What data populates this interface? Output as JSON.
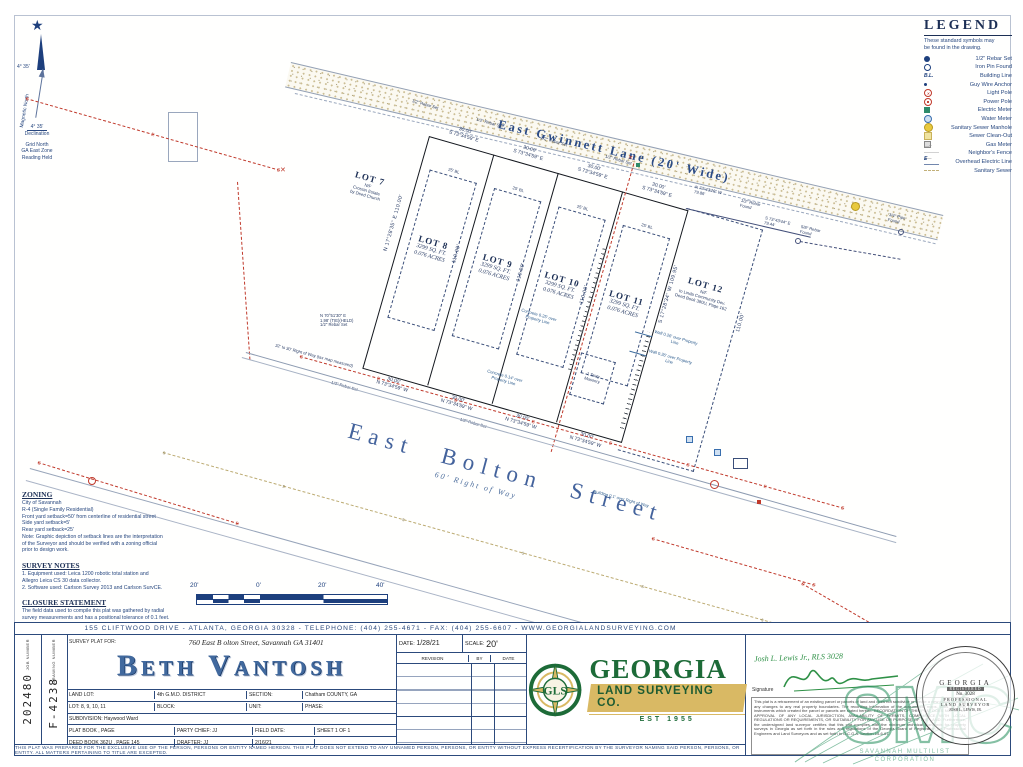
{
  "north_arrow": {
    "star": "★",
    "angle": "4° 35'",
    "magnetic": "Magnetic North",
    "declination_value": "4° 35'",
    "declination_word": "Declination",
    "grid_lines": [
      "Grid North",
      "GA East Zone",
      "Reading Held"
    ]
  },
  "legend": {
    "title": "LEGEND",
    "subtitle_lines": [
      "These standard symbols may",
      "be found in the drawing."
    ],
    "items": [
      {
        "icon": "rebar-set-icon",
        "label": "1/2\" Rebar Set"
      },
      {
        "icon": "iron-pin-found-icon",
        "label": "Iron Pin Found"
      },
      {
        "icon": "building-line-icon",
        "label": "Building Line",
        "glyph": "B.L."
      },
      {
        "icon": "guy-wire-anchor-icon",
        "label": "Guy Wire Anchor"
      },
      {
        "icon": "light-pole-icon",
        "label": "Light Pole",
        "glyph": "✕"
      },
      {
        "icon": "power-pole-icon",
        "label": "Power Pole"
      },
      {
        "icon": "electric-meter-icon",
        "label": "Electric Meter"
      },
      {
        "icon": "water-meter-icon",
        "label": "Water Meter"
      },
      {
        "icon": "sanitary-sewer-manhole-icon",
        "label": "Sanitary Sewer Manhole"
      },
      {
        "icon": "sewer-clean-out-icon",
        "label": "Sewer Clean-Out"
      },
      {
        "icon": "gas-meter-icon",
        "label": "Gas Meter"
      },
      {
        "icon": "neighbors-fence-icon",
        "label": "Neighbor's Fence",
        "glyph": "—x———x—"
      },
      {
        "icon": "overhead-electric-line-icon",
        "label": "Overhead Electric Line",
        "glyph": "E ———"
      },
      {
        "icon": "sanitary-sewer-icon",
        "label": "Sanitary Sewer"
      }
    ]
  },
  "drawing": {
    "gwinnett_label": "East Gwinnett Lane (20' Wide)",
    "bolton_label": "East Bolton Street",
    "bolton_row": "60' Right of Way",
    "symbols": {
      "e": "E",
      "s": "s",
      "x": "✕"
    },
    "lots": [
      {
        "name": "LOT 7",
        "note_lines": [
          "N/F",
          "Crossin Estate",
          "by Deed Church"
        ]
      },
      {
        "name": "LOT 8",
        "sqft": "3299 SQ. FT.",
        "acres": "0.076 ACRES"
      },
      {
        "name": "LOT 9",
        "sqft": "3299 SQ. FT.",
        "acres": "0.076 ACRES"
      },
      {
        "name": "LOT 10",
        "sqft": "3299 SQ. FT.",
        "acres": "0.076 ACRES"
      },
      {
        "name": "LOT 11",
        "sqft": "3299 SQ. FT.",
        "acres": "0.076 ACRES"
      },
      {
        "name": "LOT 12",
        "note_lines": [
          "N/F",
          "to Linda Community Dev.",
          "Deed Book 380U, Page 162"
        ]
      }
    ],
    "dims": {
      "front_dist": "30.00'",
      "front_bearing": "S 73°34'59\" E",
      "rear_bearing": "N 73°34'59\" W",
      "side_w_full": "N 17°28'35\" E  110.00'",
      "side_dist": "110.00'",
      "side_e_full": "S 17°28'34\" W  109.95'",
      "tie_w_bearing": "N 73°43'26\" W",
      "tie_w_dist": "79.86'",
      "tie_e_bearing": "S 73°43'44\" E",
      "tie_e_dist": "79.44'"
    },
    "monuments": {
      "rebar_set": "1/2\" Rebar Set",
      "rebar_found": "1/2\" Rebar Found",
      "rebar58_found": "5/8\" Rebar Found",
      "pipe34_found": "3/4\" Pipe Found"
    },
    "callouts": {
      "setback": "25' BL",
      "concrete25": "Concrete 0.25' over Property Line",
      "concrete14": "Concrete 0.14' over Property Line",
      "wall26": "Wall 0.26' over Property Line",
      "building_over": "Building 0.1' over Right of Way",
      "masonry_lines": [
        "1 Story",
        "Masonry"
      ],
      "tie_note_lines": [
        "N 70°51'30\" E",
        "1.98' (TIE)(HELD)",
        "1/2\" Rebar Set"
      ],
      "row_note": "32' to 30' Right of Way (tax map measured)"
    }
  },
  "notes": {
    "zoning_title": "ZONING",
    "zoning_lines": [
      "City of Savannah",
      "R-4 (Single Family Residential)",
      "Front yard setback=50' from centerline of residential street",
      "Side yard setback=5'",
      "Rear yard setback=25'",
      "Note: Graphic depiction of setback lines are the interpretation",
      "of the Surveyor and should be verified with a zoning official",
      "prior to design work."
    ],
    "survey_title": "SURVEY NOTES",
    "survey_lines": [
      "1.  Equipment used: Leica 1200 robotic total station and",
      "     Allegro Leica CS 30 data collector.",
      "2.  Software used: Carlson Survey 2013 and Carlson SurvCE."
    ],
    "closure_title": "CLOSURE STATEMENT",
    "closure_lines": [
      "The field data used to compile this plat was gathered by radial",
      "survey measurements and has a positional tolerance of 0.1 feet.",
      "This map or plat has been calculated for closure and is found to",
      "be accurate within one foot in 252,655 feet."
    ]
  },
  "scalebar": {
    "labels": [
      "20'",
      "0'",
      "20'",
      "40'"
    ]
  },
  "titleblock": {
    "banner": "155 CLIFTWOOD DRIVE - ATLANTA, GEORGIA 30328 - TELEPHONE: (404) 255-4671 - FAX: (404) 255-6607 - WWW.GEORGIALANDSURVEYING.COM",
    "job_number_label": "JOB NUMBER",
    "job_number": "202480",
    "drawing_number_label": "DRAWING NUMBER",
    "drawing_number": "F-4238",
    "survey_plat_for_label": "SURVEY PLAT FOR:",
    "site_address": "760 East B olton Street, Savannah GA 31401",
    "client_name": "Beth Vantosh",
    "fields": {
      "land_lot_label": "LAND LOT:",
      "district": "4th G.M.D. DISTRICT",
      "section_label": "SECTION:",
      "county": "Chatham COUNTY, GA",
      "lot_label": "LOT:  8, 9, 10, 11",
      "block_label": "BLOCK:",
      "unit_label": "UNIT:",
      "phase_label": "PHASE:",
      "subdivision": "SUBDIVISION:  Haywood Ward",
      "plat_book": "PLAT BOOK          , PAGE",
      "party_chief": "PARTY CHIEF:   JJ",
      "field_date_label": "FIELD DATE:",
      "field_date": "2/16/21",
      "sheet": "SHEET   1   OF   1",
      "deed_book": "DEED BOOK  362U    , PAGE  145",
      "drafter": "DRAFTER:        JJ"
    },
    "date_label": "DATE:",
    "date": "1/28/21",
    "scale_label": "SCALE:",
    "scale": "20'",
    "revision_header": [
      "REVISION",
      "BY",
      "DATE"
    ],
    "logo": {
      "monogram": "GLS",
      "name": "GEORGIA",
      "subname": "LAND SURVEYING CO.",
      "est": "EST 1955"
    },
    "surveyor": {
      "name_line": "Josh L. Lewis Jr., RLS 3028",
      "signature_label": "Signature",
      "certification": "This plat is a retracement of an existing parcel or parcels of land and does not subdivide or create a new parcel or make any changes to any real property boundaries. The recording information of the documents, maps, plats, or other instruments which created the parcel or parcels are stated hereon. RECORDATION OF THIS PLAT DOES NOT IMPLY APPROVAL OF ANY LOCAL JURISDICTION, AVAILABILITY OF PERMITS, COMPLIANCE WITH LOCAL REGULATIONS OR REQUIREMENTS, OR SUITABILITY FOR ANY USE OR PURPOSE OF THE LAND. Furthermore, the undersigned land surveyor certifies that this plat complies with the minimum technical standards for property surveys in Georgia as set forth in the rules and regulations of the Georgia Board of Registration for Professional Engineers and Land Surveyors and as set forth in O.C.G.A. Section 15-6-67."
    },
    "seal": {
      "top": "GEORGIA",
      "registered": "REGISTERED",
      "number": "No. 3028",
      "middle": "PROFESSIONAL",
      "bottom": "LAND SURVEYOR",
      "name": "JOSH L. LEWIS, JR."
    },
    "watermark": {
      "letters": "SMC",
      "caption_lines": [
        "SAVANNAH MULTILIST",
        "CORPORATION"
      ]
    },
    "disclaimer": "THIS PLAT WAS PREPARED FOR THE EXCLUSIVE USE OF THE PERSON, PERSONS OR ENTITY NAMED HEREON.  THIS PLAT DOES NOT EXTEND TO ANY UNNAMED PERSON, PERSONS, OR ENTITY WITHOUT EXPRESS RECERTIFICATION BY THE SURVEYOR NAMING SAID PERSON, PERSONS, OR ENTITY.  ALL MATTERS PERTAINING TO TITLE ARE EXCEPTED."
  }
}
